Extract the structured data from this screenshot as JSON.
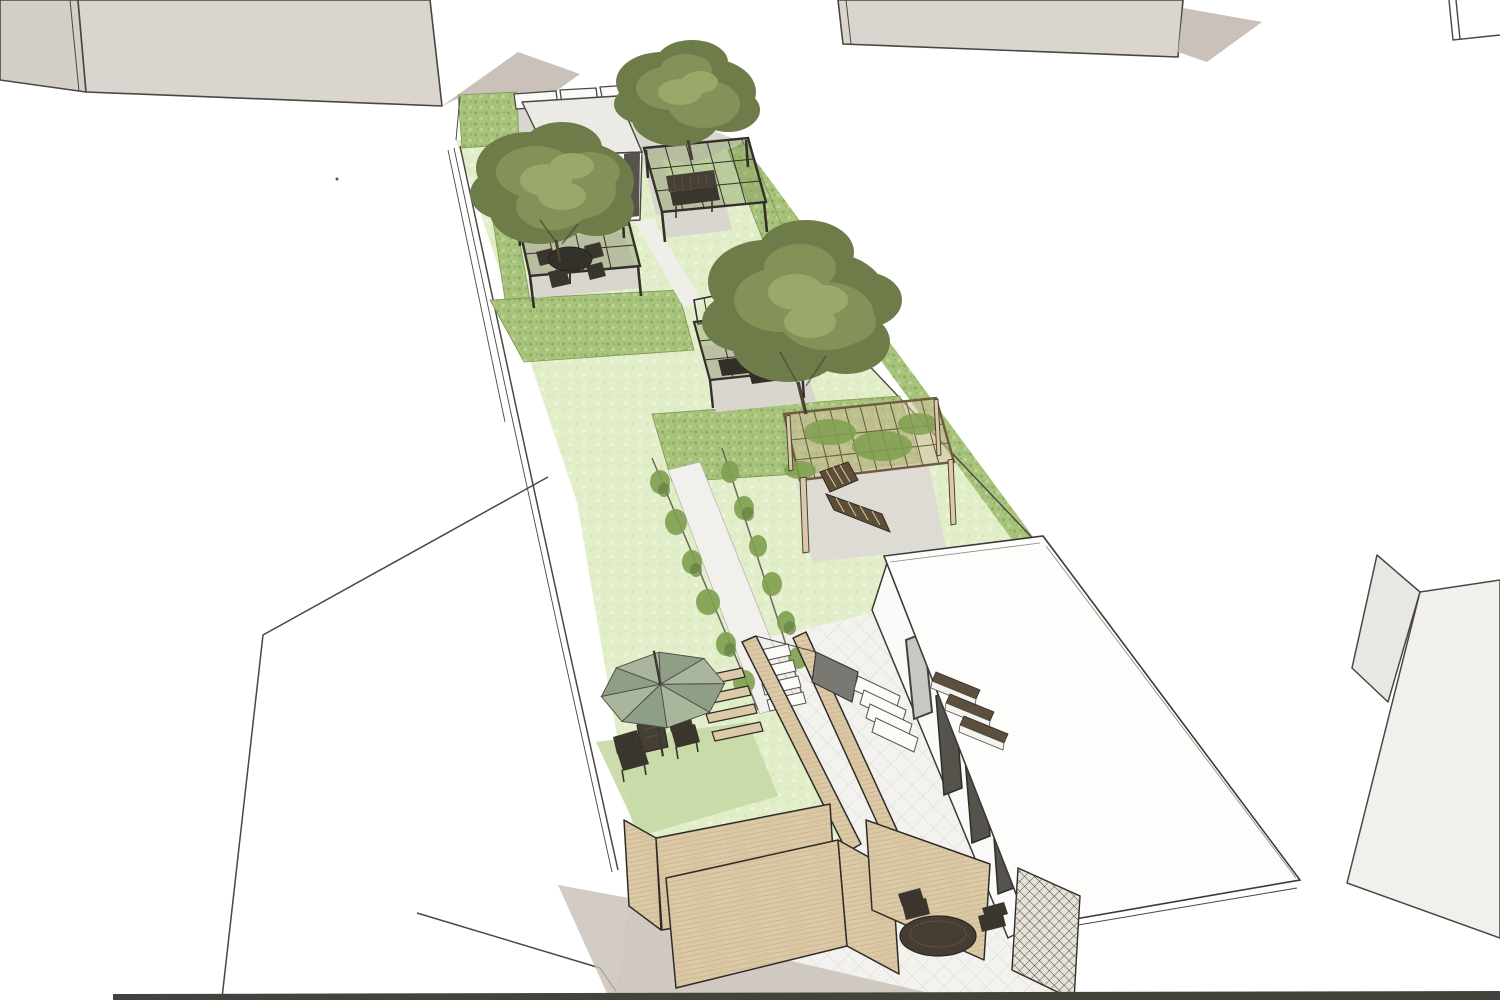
{
  "scene": {
    "kind": "3d-landscape-design-rendering",
    "style": "sketchup-perspective",
    "elements": [
      {
        "name": "building-mass-top-left",
        "type": "neighbouring building block, grey"
      },
      {
        "name": "building-mass-top-right",
        "type": "neighbouring building block, grey"
      },
      {
        "name": "building-outline-bottom-left",
        "type": "neighbouring roof outline, white"
      },
      {
        "name": "building-mass-bottom-right",
        "type": "neighbouring building block, light grey"
      },
      {
        "name": "garden-strip",
        "type": "long narrow lawn garden running diagonally"
      },
      {
        "name": "entrance-paving",
        "type": "grey paved drive at top with white wall piers"
      },
      {
        "name": "garden-shed",
        "type": "small white flat-roof shed"
      },
      {
        "name": "pergola-bench",
        "type": "dark timber pergola with garden bench"
      },
      {
        "name": "pergola-dining",
        "type": "dark timber pergola with round table and chairs"
      },
      {
        "name": "pergola-tree-terrace",
        "type": "dark timber pergola under large tree"
      },
      {
        "name": "pergola-lounge",
        "type": "light timber pergola with sun lounger"
      },
      {
        "name": "hedges",
        "type": "clipped hedge blocks dividing garden rooms"
      },
      {
        "name": "trees",
        "type": "three large olive-green tree canopies"
      },
      {
        "name": "vine-walk",
        "type": "gravel path flanked by climber trellises"
      },
      {
        "name": "parasol-lawn",
        "type": "lawn with green parasol, two chairs and table"
      },
      {
        "name": "sleeper-steps",
        "type": "timber plank steps in lawn"
      },
      {
        "name": "timber-screens",
        "type": "light timber screen walls forming courtyards"
      },
      {
        "name": "tiled-patio",
        "type": "diamond-tiled patio with steps and benches"
      },
      {
        "name": "garden-building",
        "type": "white flat-roofed studio with glazed doors"
      },
      {
        "name": "patio-table-set",
        "type": "dark round table with two chairs"
      }
    ]
  },
  "palette": {
    "paper": "#ffffff",
    "line": "#4a4741",
    "bldg_side": "#d3cfc8",
    "bldg_front": "#dad6cf",
    "bldg_shadow": "#c7bfb6",
    "bldg_light": "#e9e7e3",
    "bldg_lighter": "#f2f0ed",
    "lawn": "#e1eec9",
    "lawn_spot_light": "#eef6dd",
    "lawn_spot_dark": "#d2e3af",
    "lawn_shade": "#c6d8a4",
    "hedge": "#a8c37c",
    "hedge_dot_dark": "#8aa85e",
    "hedge_dot_light": "#c2d79a",
    "hedge_edge": "#7d9552",
    "tree_dark": "#6e7c4a",
    "tree_mid": "#86955a",
    "tree_light": "#9fae6c",
    "trunk": "#4b4232",
    "pave": "#d9d6d0",
    "pave_light": "#dedbd4",
    "gravel": "#efeee9",
    "tile": "#f3f2ee",
    "tile_line": "#d9d9d2",
    "wood_dark": "#332f2a",
    "wood_tan": "#dcc9a7",
    "wood_grain": "#c8b28a",
    "wood_mid": "#6d5c40",
    "furn_dark": "#3a352d",
    "canvas_a": "#8e9f85",
    "canvas_b": "#a9b69c",
    "white_wall": "#fafaf8",
    "glass": "#c9c7c1",
    "door_dark": "#56534d",
    "retain": "#7a7872",
    "strip": "#44423c",
    "path_white": "#f1f0ec",
    "vine": "#7fa050",
    "vine_dark": "#628140"
  }
}
